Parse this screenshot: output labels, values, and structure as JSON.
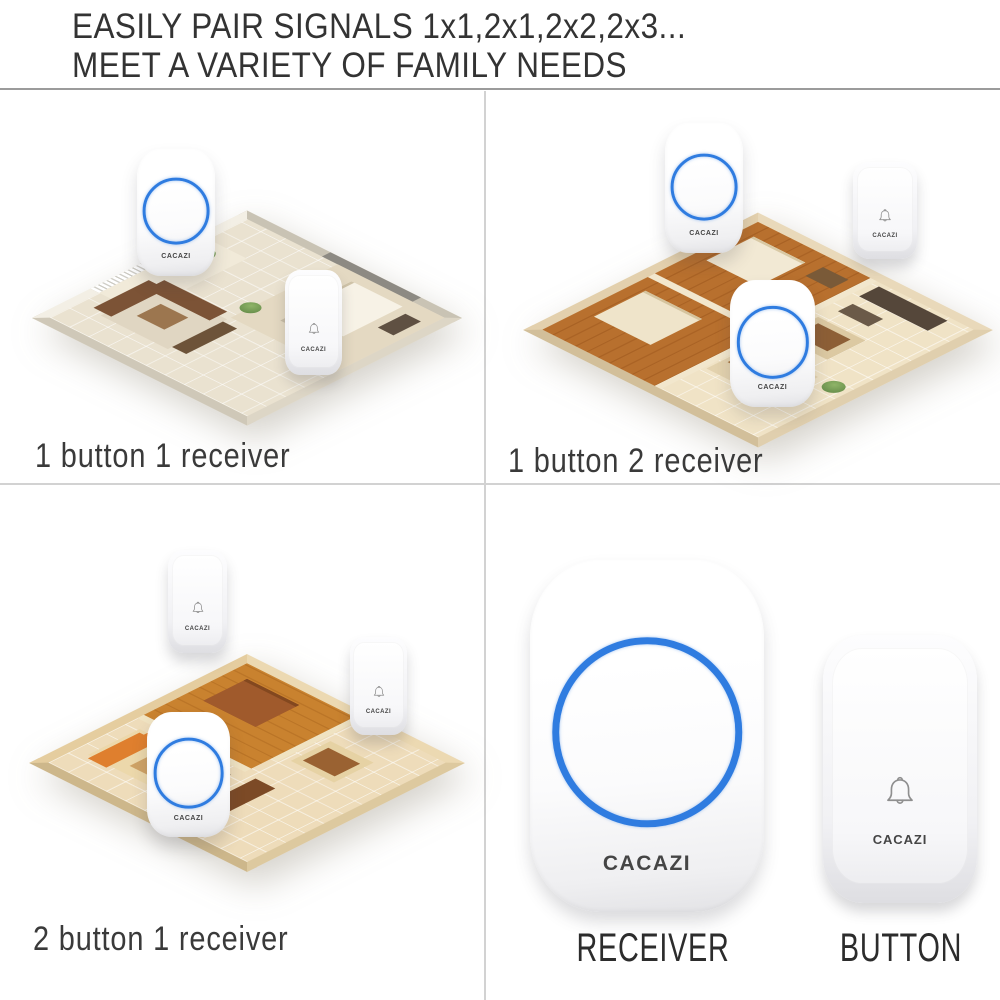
{
  "header": {
    "line1": "EASILY PAIR SIGNALS 1x1,2x1,2x2,2x3...",
    "line2": "MEET A VARIETY OF FAMILY NEEDS"
  },
  "brand": "CACAZI",
  "panels": {
    "one_one": {
      "caption": "1 button 1 receiver"
    },
    "one_two": {
      "caption": "1 button 2 receiver"
    },
    "two_one": {
      "caption": "2 button 1 receiver"
    },
    "products": {
      "receiver_label": "RECEIVER",
      "button_label": "BUTTON"
    }
  },
  "colors": {
    "led_ring_blue": "#2f7ce0",
    "header_divider": "#9b9b9b",
    "grid_divider": "#d2d2d2"
  }
}
